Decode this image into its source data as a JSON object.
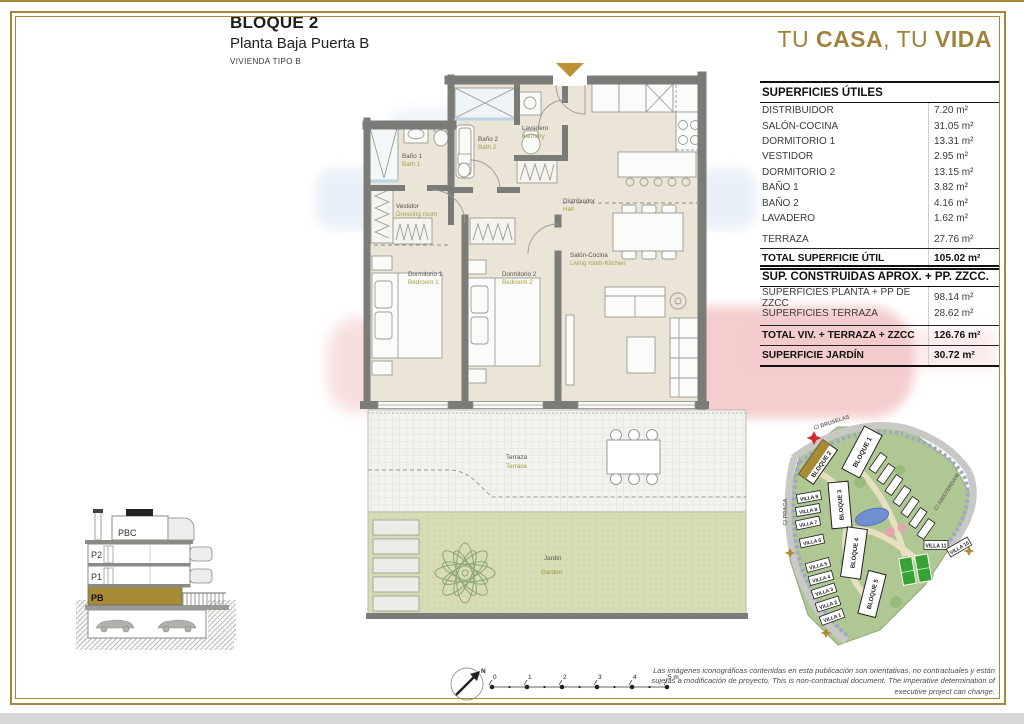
{
  "header": {
    "block": "BLOQUE 2",
    "floor": "Planta Baja Puerta B",
    "type": "VIVIENDA TIPO B",
    "slogan_parts": [
      "TU ",
      "CASA",
      ", TU ",
      "VIDA"
    ]
  },
  "tables": {
    "utiles": {
      "title": "SUPERFICIES ÚTILES",
      "rows": [
        {
          "label": "DISTRIBUIDOR",
          "value": "7.20 m²"
        },
        {
          "label": "SALÓN-COCINA",
          "value": "31.05 m²"
        },
        {
          "label": "DORMITORIO 1",
          "value": "13.31 m²"
        },
        {
          "label": "VESTIDOR",
          "value": "2.95 m²"
        },
        {
          "label": "DORMITORIO 2",
          "value": "13.15 m²"
        },
        {
          "label": "BAÑO 1",
          "value": "3.82 m²"
        },
        {
          "label": "BAÑO 2",
          "value": "4.16 m²"
        },
        {
          "label": "LAVADERO",
          "value": "1.62 m²"
        }
      ],
      "terraza": {
        "label": "TERRAZA",
        "value": "27.76 m²"
      },
      "total": {
        "label": "TOTAL SUPERFICIE ÚTIL",
        "value": "105.02 m²"
      }
    },
    "construidas": {
      "title": "SUP. CONSTRUIDAS APROX. + PP. ZZCC.",
      "rows": [
        {
          "label": "SUPERFICIES PLANTA + PP DE ZZCC",
          "value": "98.14 m²"
        },
        {
          "label": "SUPERFICIES TERRAZA",
          "value": "28.62 m²"
        }
      ],
      "total": {
        "label": "TOTAL VIV. + TERRAZA + ZZCC",
        "value": "126.76 m²"
      },
      "jardin": {
        "label": "SUPERFICIE JARDÍN",
        "value": "30.72 m²"
      }
    }
  },
  "plan": {
    "rooms": {
      "bano1": {
        "es": "Baño 1",
        "en": "Bath 1"
      },
      "bano2": {
        "es": "Baño 2",
        "en": "Bath 2"
      },
      "lavadero": {
        "es": "Lavadero",
        "en": "Laundry"
      },
      "vestidor": {
        "es": "Vestidor",
        "en": "Dressing room"
      },
      "distribuidor": {
        "es": "Distribuidor",
        "en": "Hall"
      },
      "dorm1": {
        "es": "Dormitorio 1",
        "en": "Bedroom 1"
      },
      "dorm2": {
        "es": "Dormitorio 2",
        "en": "Bedroom 2"
      },
      "salon": {
        "es": "Salón-Cocina",
        "en": "Living room-Kitchen"
      },
      "terraza": {
        "es": "Terraza",
        "en": "Terrace"
      },
      "jardin": {
        "es": "Jardín",
        "en": "Garden"
      }
    }
  },
  "section": {
    "floors": [
      "PBC",
      "P2",
      "P1",
      "PB"
    ],
    "highlighted_floor": "PB"
  },
  "siteplan": {
    "streets": [
      "C/ BRUSELAS",
      "C/ AMSTERDAM",
      "C/ PRAGA"
    ],
    "blocks": [
      "BLOQUE 1",
      "BLOQUE 2",
      "BLOQUE 3",
      "BLOQUE 4",
      "BLOQUE 5"
    ],
    "villas_left": [
      "VILLA 9",
      "VILLA 8",
      "VILLA 7",
      "VILLA 6",
      "VILLA 5",
      "VILLA 4",
      "VILLA 3",
      "VILLA 2",
      "VILLA 1"
    ],
    "villas_right": [
      "VILLA 11",
      "VILLA 10"
    ],
    "highlighted_block": "BLOQUE 2"
  },
  "scalebar": {
    "labels": [
      "0",
      "1",
      "2",
      "3",
      "4",
      "5 m"
    ],
    "north": "N"
  },
  "disclaimer": "Las imágenes iconográficas contenidas en esta publicación son orientativas, no contractuales y están sujetas a modificación de proyecto. This is non-contractual document. The imperative determination of executive project can change.",
  "colors": {
    "gold": "#A8873B",
    "highlight_gold": "#A98A35",
    "wall_gray": "#7B7B78",
    "floor_beige": "#EBE5D8",
    "garden_green": "#D8DCB6",
    "terrace_gray": "#F2F2EE",
    "label_es": "#55534E",
    "label_en": "#A0A23B",
    "marker_red": "#D42B2B"
  }
}
